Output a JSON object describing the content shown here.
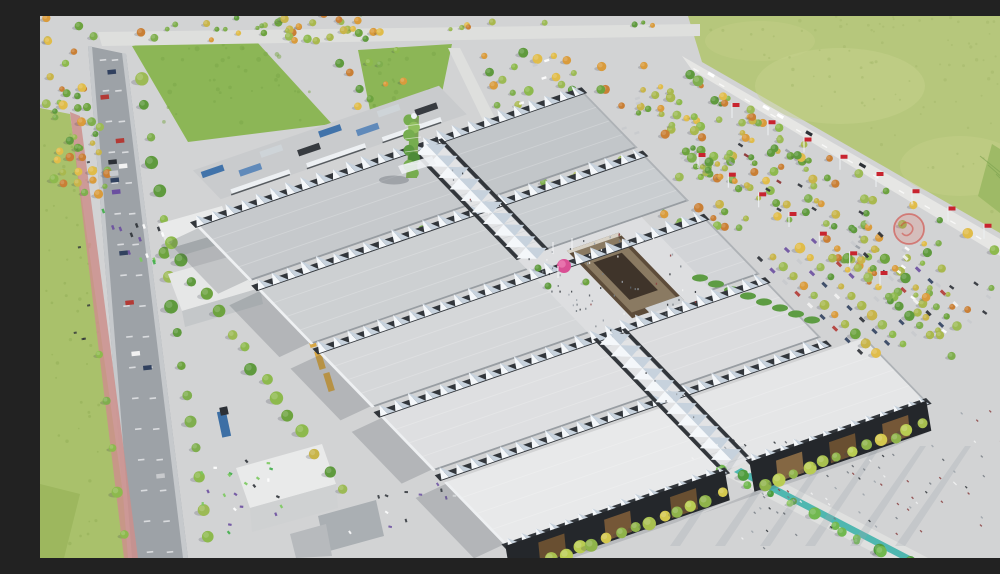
{
  "meta": {
    "title": "Aerial rendering of an exhibition center masterplan",
    "description": "Bird's-eye architectural rendering: two columns of large flat-roofed exhibition halls joined by a central boulevard covered with white wavy tensile canopies, a vertical-garden tower at the north end, a brown conference building and pink sphere sculpture at the central plaza, event lawns and a bus depot to the north-west, tree-covered parking lots, a flag-lined east entrance with a red circular logo marker, perimeter roads with traffic, farm fields at the edges, and a canal promenade leaving the south gate."
  },
  "scene": {
    "palette": {
      "ground": "#d2d3d4",
      "pavement": "#d8d9da",
      "asphalt": "#9da2a7",
      "roadLight": "#e6e6e4",
      "topRoad": "#dedfdd",
      "bike": "#cc8f8c",
      "lawn": "#8cb656",
      "lawnSpeck": "#79a548",
      "fieldNE": "#b6c77c",
      "fieldNEpatch": "#c8d28d",
      "fieldLeft": "#a9c16b",
      "vineyard": "#9eba66",
      "vineRow": "#7fa452",
      "spine": "#e2e3e5",
      "plaza": "#dddee0",
      "canopyLight": "#f4f7fa",
      "canopyShade": "#c7d2dd",
      "canopyDark": "#32363b",
      "roofW": [
        "#c6c9cc",
        "#cdd0d2",
        "#d5d7d9",
        "#dedfe1"
      ],
      "roofE": [
        "#c2c6c9",
        "#c9cdd0",
        "#d2d4d7",
        "#dbdcde"
      ],
      "roofF": [
        "#e8e9ea",
        "#e5e6e7"
      ],
      "roofEdge": "#989da2",
      "roofWestEdge": "#eef0f2",
      "facade": "#24272b",
      "facadeWood": [
        "#7a5a38",
        "#8a6a44",
        "#6e5132"
      ],
      "brownWall": "#5d4c3a",
      "brownRoof": "#8a7a62",
      "brownDark": "#3f342a",
      "brownTrim": "#d8d2c6",
      "towerGreens": [
        "#4e8a38",
        "#76ad4f",
        "#8fbe5d",
        "#5d9a41"
      ],
      "treeGreens": [
        "#6da33f",
        "#8db94d",
        "#7fae4e",
        "#9cba55",
        "#5f9a3e"
      ],
      "treeAutumn": [
        "#d99b3c",
        "#c8b44a",
        "#c97f35",
        "#e0bc4a",
        "#a9b84e"
      ],
      "treeLime": [
        "#b9cc52",
        "#8fb34a",
        "#d4c84e",
        "#a8c04f"
      ],
      "flagRed": "#c8242f",
      "logoRed": "#cf3b33",
      "pink": "#d94f94",
      "pinkLight": "#e873ad",
      "teal": "#3fb3ab",
      "busBlue": [
        "#3a6ea8",
        "#5b86b8",
        "#cfd4d8",
        "#2f3338"
      ],
      "truckYellow": "#d8a43c",
      "truckBlue": "#3d6fa5",
      "shadow": "#39404d",
      "speck": [
        "#5a5f66",
        "#777d84",
        "#2e3237",
        "#9aa1a8",
        "#f2f2f2",
        "#8a4040"
      ],
      "carColors": [
        "#2c3036",
        "#f2f2f2",
        "#c8cacd",
        "#b33a35",
        "#31415f",
        "#6b4fa0"
      ],
      "stallColors": [
        "#3fae49",
        "#6b4fa0",
        "#ffffff",
        "#2f3338",
        "#7bc95e"
      ]
    },
    "landmarks": [
      {
        "name": "exhibition-halls",
        "note": "8 large flat-roof halls in two columns plus 2 taller foreground halls with dark timber facades"
      },
      {
        "name": "central-boulevard",
        "note": "diagonal axis covered by white wavy sail canopies"
      },
      {
        "name": "vertical-garden-tower",
        "note": "green planted tower at north end of the axis"
      },
      {
        "name": "conference-building",
        "note": "brown multi-level block at the central crossing"
      },
      {
        "name": "pink-sphere-sculpture",
        "note": "magenta sphere on the central plaza"
      },
      {
        "name": "event-lawns",
        "note": "two green lawns at the north-west"
      },
      {
        "name": "bus-depot",
        "note": "bus rows with white shelter canopies"
      },
      {
        "name": "tree-covered-parking",
        "note": "parking lots dotted with green and autumn trees"
      },
      {
        "name": "east-entrance-flags",
        "note": "white masts with red flags"
      },
      {
        "name": "red-logo-marker",
        "note": "translucent red circular emblem over the east esplanade"
      },
      {
        "name": "perimeter-road",
        "note": "west road with traffic and red cycle path"
      },
      {
        "name": "north-east-highway",
        "note": "diagonal road separating the fairground from farm fields"
      },
      {
        "name": "canal-promenade",
        "note": "tree-lined walk with teal water channel at the south gate"
      },
      {
        "name": "logistics-warehouses",
        "note": "white service sheds and truck yard on the west side"
      }
    ],
    "config": {
      "hallRows": 4,
      "foregroundHalls": 2,
      "treesTopLots": 260,
      "treesEastParking": 110,
      "busCount": 8,
      "flagCount": 16,
      "roadCars": 14,
      "plazaPeople": 70,
      "esplanadeSpecks": 110
    }
  }
}
